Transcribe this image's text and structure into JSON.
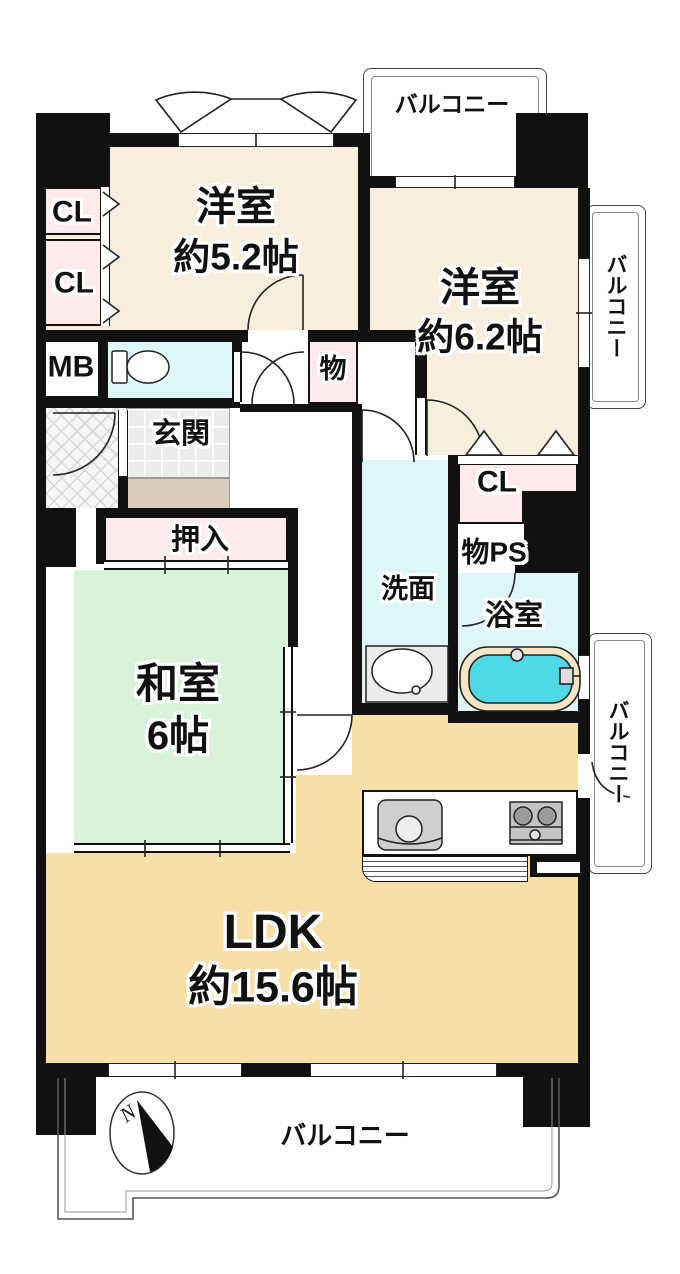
{
  "plan": {
    "balcony_label": "バルコニー",
    "compass": "N",
    "rooms": {
      "western1": {
        "name": "洋室",
        "size": "約5.2帖"
      },
      "western2": {
        "name": "洋室",
        "size": "約6.2帖"
      },
      "japanese": {
        "name": "和室",
        "size": "6帖"
      },
      "ldk": {
        "name": "LDK",
        "size": "約15.6帖"
      },
      "entrance": "玄関",
      "futon_closet": "押入",
      "washroom": "洗面",
      "bathroom": "浴室",
      "storage": "物",
      "storage_pipe_space": "物PS",
      "closet": "CL",
      "meter_box": "MB"
    },
    "colors": {
      "wall": "#111111",
      "western_room": "#f7eedd",
      "tatami_room": "#d9f2d9",
      "ldk": "#f6e0a8",
      "closet": "#fdeaea",
      "wet_area": "#dff6f8",
      "bathtub": "#4dd9e6",
      "entrance_tile": "#ececec",
      "entrance_step": "#d9ccbb"
    }
  }
}
